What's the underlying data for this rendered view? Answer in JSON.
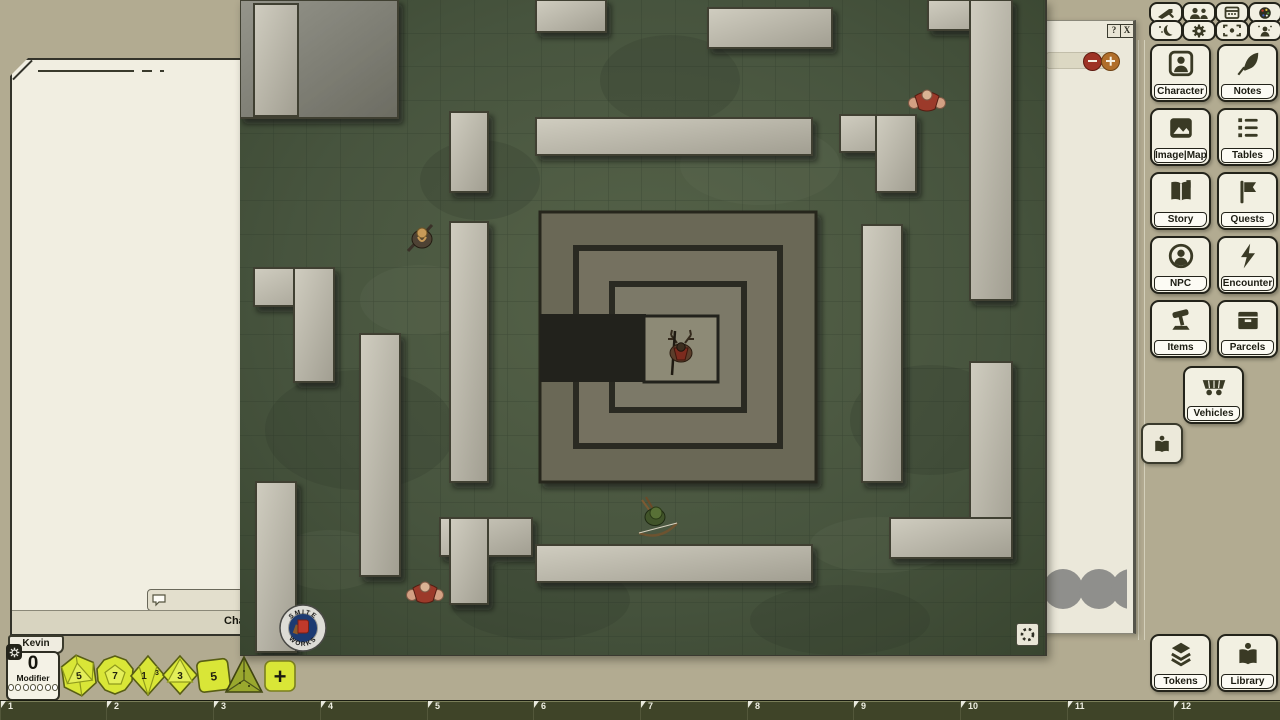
{
  "chat": {
    "mode_label": "Chat",
    "user_tab": "Kevin"
  },
  "modifier": {
    "value": "0",
    "label": "Modifier"
  },
  "side_panel": {
    "help_label": "?",
    "close_label": "X"
  },
  "map": {
    "logo_top": "SMITE",
    "logo_bottom": "WORKS"
  },
  "top_toolbar": {
    "icons": [
      "sword",
      "users",
      "calendar",
      "palette",
      "moon",
      "gear",
      "focus",
      "person-effects"
    ]
  },
  "sidebar": {
    "buttons": [
      {
        "label": "Character",
        "icon": "person-card"
      },
      {
        "label": "Notes",
        "icon": "quill"
      },
      {
        "label": "Image|Map",
        "icon": "image"
      },
      {
        "label": "Tables",
        "icon": "list"
      },
      {
        "label": "Story",
        "icon": "open-book"
      },
      {
        "label": "Quests",
        "icon": "flag"
      },
      {
        "label": "NPC",
        "icon": "person-circle"
      },
      {
        "label": "Encounter",
        "icon": "lightning"
      },
      {
        "label": "Items",
        "icon": "gavel"
      },
      {
        "label": "Parcels",
        "icon": "box"
      },
      {
        "label": "Vehicles",
        "icon": "wagon"
      }
    ],
    "bottom_buttons": [
      {
        "label": "Tokens",
        "icon": "layers"
      },
      {
        "label": "Library",
        "icon": "book-person"
      }
    ]
  },
  "dice": {
    "items": [
      {
        "die": "d20",
        "face": "5"
      },
      {
        "die": "d12",
        "face": "7"
      },
      {
        "die": "d10",
        "face": "1",
        "side_face": "3"
      },
      {
        "die": "d8",
        "face": "3"
      },
      {
        "die": "d6",
        "face": "5"
      },
      {
        "die": "d4",
        "face": ""
      }
    ],
    "add_label": "+"
  },
  "hotbar": {
    "slots": [
      "1",
      "2",
      "3",
      "4",
      "5",
      "6",
      "7",
      "8",
      "9",
      "10",
      "11",
      "12"
    ]
  },
  "colors": {
    "desktop": "#b2ab91",
    "button_cream": "#f2f0e2",
    "icon_olive": "#3a3a25",
    "hotbar": "#3f4428",
    "dice_yellow": "#d9e637",
    "zoom_out_red": "#9e3325",
    "zoom_in_orange": "#b06e2a",
    "map_floor_green": "#47543e",
    "wall_gray": "#b5b2a4"
  }
}
